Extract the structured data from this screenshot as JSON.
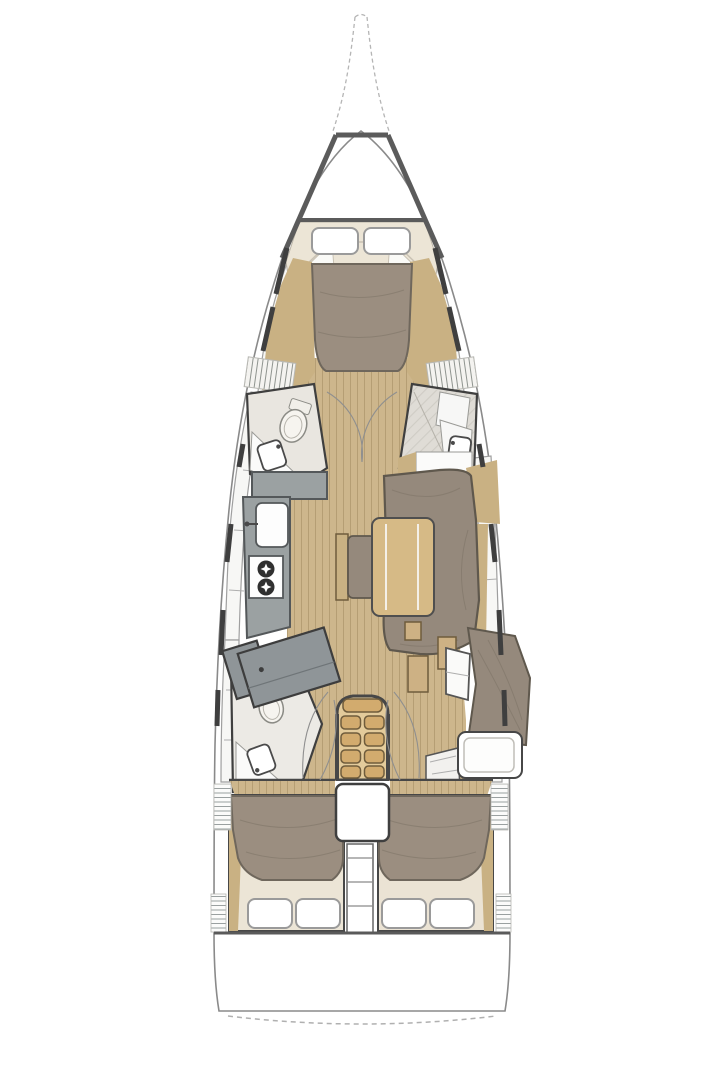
{
  "figure": {
    "type": "floor-plan",
    "subject": "sailing-yacht-interior-deck-plan",
    "orientation": "bow-up",
    "visible_text": "none"
  },
  "palette": {
    "background": "#ffffff",
    "hull_outline": "#8a8a8a",
    "deck_structure_line": "#5b5b5b",
    "interior_wall": "#3f3f3f",
    "floor_wood": "#cdb68c",
    "floor_plank_line": "#b59e74",
    "side_wood_trim": "#c9b183",
    "table_wood": "#d6ba86",
    "stair_wood": "#e3cb9b",
    "stair_tread": "#d2ab6e",
    "upholstery_grey": "#95897c",
    "upholstery_outline": "#5f584d",
    "duvet_taupe": "#9b8e80",
    "duvet_outline": "#6f675c",
    "mattress_cream": "#ece5d6",
    "galley_counter_grey": "#9ba1a2",
    "shower_partition_grey": "#8f9598",
    "locker_white": "#f7f7f5",
    "fixture_white": "#fdfdfd",
    "hatch_line_grey": "#9aa0a0",
    "bowsprit_dash_grey": "#b5b5b5"
  },
  "areas": {
    "bow": {
      "symbols": [
        "bowsprit-dashed-outline",
        "foredeck-trapezoid-frame"
      ]
    },
    "forward_cabin": {
      "symbols": [
        "double-berth",
        "duvet",
        "pillow-x2",
        "side-lockers",
        "vent-grilles",
        "wood-trim"
      ]
    },
    "forward_head_port": {
      "symbols": [
        "toilet",
        "sink",
        "counter",
        "door-arc"
      ]
    },
    "forward_shower_starboard": {
      "symbols": [
        "shower-floor",
        "bench",
        "sink",
        "door-arc"
      ]
    },
    "galley_port": {
      "symbols": [
        "l-shaped-counter",
        "sink-with-faucet",
        "two-burner-stove"
      ]
    },
    "salon_starboard": {
      "symbols": [
        "u-shaped-settee",
        "dining-table",
        "bench-seat",
        "hull-lockers",
        "wood-trim"
      ]
    },
    "aft_head_port": {
      "symbols": [
        "shower-partition",
        "toilet",
        "sink",
        "counter"
      ]
    },
    "nav_area_starboard": {
      "symbols": [
        "upholstered-seat",
        "chart-desk-with-cushion",
        "lockers",
        "entry-steps",
        "wood-boxes"
      ]
    },
    "companionway": {
      "symbols": [
        "stairs-4-steps",
        "engine-hatch",
        "ladder-passage"
      ]
    },
    "aft_cabin_port": {
      "symbols": [
        "double-berth",
        "duvet",
        "pillow-x2",
        "wood-trim"
      ]
    },
    "aft_cabin_starboard": {
      "symbols": [
        "double-berth",
        "duvet",
        "pillow-x2",
        "wood-trim"
      ]
    },
    "transom": {
      "symbols": [
        "swim-platform-dashed-curve"
      ]
    },
    "hull_sides": {
      "symbols": [
        "window-dashes-6-per-side",
        "vent-hatch-strips"
      ]
    }
  },
  "counts": {
    "pillows": 6,
    "cabins": 3,
    "heads": 2,
    "hull_window_dashes": 12
  }
}
